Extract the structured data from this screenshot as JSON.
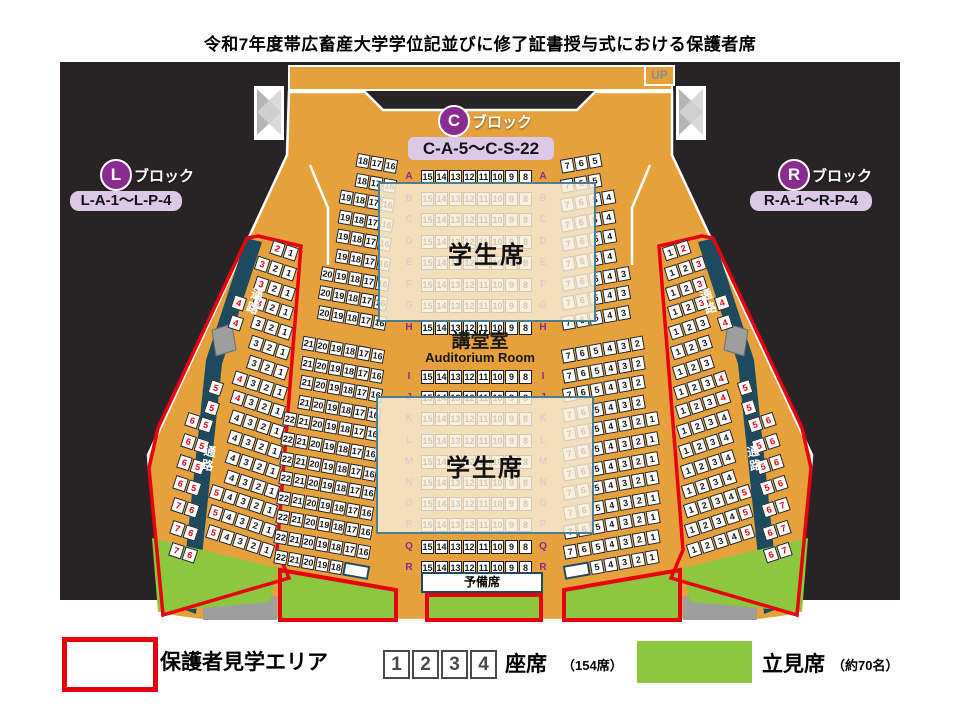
{
  "title": "令和7年度帯広畜産大学学位記並びに修了証書授与式における保護者席",
  "map": {
    "up_label": "UP",
    "blocks": {
      "c": {
        "letter": "C",
        "suffix": "ブロック",
        "range": "C-A-5〜C-S-22"
      },
      "l": {
        "letter": "L",
        "suffix": "ブロック",
        "range": "L-A-1〜L-P-4"
      },
      "r": {
        "letter": "R",
        "suffix": "ブロック",
        "range": "R-A-1〜R-P-4"
      }
    },
    "hall_name": "講堂室",
    "hall_name_en": "Auditorium Room",
    "student_area_label": "学生席",
    "reserve_label": "予備席",
    "aisle_label": "通路",
    "center_block": {
      "row_letters": [
        "A",
        "B",
        "C",
        "D",
        "E",
        "F",
        "G",
        "H",
        "I",
        "J",
        "K",
        "L",
        "M",
        "N",
        "O",
        "P",
        "Q",
        "R"
      ],
      "seat_numbers": [
        "15",
        "14",
        "13",
        "12",
        "11",
        "10",
        "9",
        "8"
      ]
    },
    "left_column_rows": [
      [
        "18",
        "17",
        "16"
      ],
      [
        "18",
        "17",
        "16"
      ],
      [
        "19",
        "18",
        "17",
        "16"
      ],
      [
        "19",
        "18",
        "17",
        "16"
      ],
      [
        "19",
        "18",
        "17",
        "16"
      ],
      [
        "19",
        "18",
        "17",
        "16"
      ],
      [
        "20",
        "19",
        "18",
        "17",
        "16"
      ],
      [
        "20",
        "19",
        "18",
        "17",
        "16"
      ],
      [
        "20",
        "19",
        "18",
        "17",
        "16"
      ],
      [
        "21",
        "20",
        "19",
        "18",
        "17",
        "16"
      ],
      [
        "21",
        "20",
        "19",
        "18",
        "17",
        "16"
      ],
      [
        "21",
        "20",
        "19",
        "18",
        "17",
        "16"
      ],
      [
        "21",
        "20",
        "19",
        "18",
        "17",
        "16"
      ],
      [
        "22",
        "21",
        "20",
        "19",
        "18",
        "17",
        "16"
      ],
      [
        "22",
        "21",
        "20",
        "19",
        "18",
        "17",
        "16"
      ],
      [
        "22",
        "21",
        "20",
        "19",
        "18",
        "17",
        "16"
      ],
      [
        "22",
        "21",
        "20",
        "19",
        "18",
        "17",
        "16"
      ],
      [
        "22",
        "21",
        "20",
        "19",
        "18",
        "17",
        "16"
      ],
      [
        "22",
        "21",
        "20",
        "19",
        "18",
        "17",
        "16"
      ],
      [
        "22",
        "21",
        "20",
        "19",
        "18",
        "17",
        "16"
      ],
      [
        "22",
        "21",
        "20",
        "19",
        "18",
        ""
      ]
    ],
    "right_column_rows": [
      [
        "7",
        "6",
        "5"
      ],
      [
        "7",
        "6",
        "5"
      ],
      [
        "7",
        "6",
        "5",
        "4"
      ],
      [
        "7",
        "6",
        "5",
        "4"
      ],
      [
        "7",
        "6",
        "5",
        "4"
      ],
      [
        "7",
        "6",
        "5",
        "4"
      ],
      [
        "7",
        "6",
        "5",
        "4",
        "3"
      ],
      [
        "7",
        "6",
        "5",
        "4",
        "3"
      ],
      [
        "7",
        "6",
        "5",
        "4",
        "3"
      ],
      [
        "7",
        "6",
        "5",
        "4",
        "3",
        "2"
      ],
      [
        "7",
        "6",
        "5",
        "4",
        "3",
        "2"
      ],
      [
        "7",
        "6",
        "5",
        "4",
        "3",
        "2"
      ],
      [
        "7",
        "6",
        "5",
        "4",
        "3",
        "2"
      ],
      [
        "7",
        "6",
        "5",
        "4",
        "3",
        "2",
        "1"
      ],
      [
        "7",
        "6",
        "5",
        "4",
        "3",
        "2",
        "1"
      ],
      [
        "7",
        "6",
        "5",
        "4",
        "3",
        "2",
        "1"
      ],
      [
        "7",
        "6",
        "5",
        "4",
        "3",
        "2",
        "1"
      ],
      [
        "7",
        "6",
        "5",
        "4",
        "3",
        "2",
        "1"
      ],
      [
        "7",
        "6",
        "5",
        "4",
        "3",
        "2",
        "1"
      ],
      [
        "7",
        "6",
        "5",
        "4",
        "3",
        "2",
        "1"
      ],
      [
        "",
        "5",
        "4",
        "3",
        "2",
        "1"
      ]
    ],
    "left_wing": {
      "main_rows": [
        {
          "s": [
            "2",
            "1"
          ],
          "red": [
            0
          ]
        },
        {
          "s": [
            "3",
            "2",
            "1"
          ],
          "red": [
            0
          ]
        },
        {
          "s": [
            "3",
            "2",
            "1"
          ],
          "red": [
            0
          ]
        },
        {
          "s": [
            "3",
            "2",
            "1"
          ],
          "red": [
            0
          ]
        },
        {
          "s": [
            "3",
            "2",
            "1"
          ],
          "red": []
        },
        {
          "s": [
            "3",
            "2",
            "1"
          ],
          "red": []
        },
        {
          "s": [
            "3",
            "2",
            "1"
          ],
          "red": []
        },
        {
          "s": [
            "4",
            "3",
            "2",
            "1"
          ],
          "red": [
            0
          ]
        },
        {
          "s": [
            "4",
            "3",
            "2",
            "1"
          ],
          "red": [
            0
          ]
        },
        {
          "s": [
            "4",
            "3",
            "2",
            "1"
          ],
          "red": []
        },
        {
          "s": [
            "4",
            "3",
            "2",
            "1"
          ],
          "red": []
        },
        {
          "s": [
            "4",
            "3",
            "2",
            "1"
          ],
          "red": []
        },
        {
          "s": [
            "4",
            "3",
            "2",
            "1"
          ],
          "red": []
        },
        {
          "s": [
            "5",
            "4",
            "3",
            "2",
            "1"
          ],
          "red": [
            0
          ]
        },
        {
          "s": [
            "5",
            "4",
            "3",
            "2",
            "1"
          ],
          "red": [
            0
          ]
        },
        {
          "s": [
            "5",
            "4",
            "3",
            "2",
            "1"
          ],
          "red": [
            0
          ]
        }
      ],
      "outer_rows": [
        {
          "s": [
            "4"
          ],
          "red": [
            0
          ]
        },
        {
          "s": [
            "4"
          ],
          "red": [
            0
          ]
        },
        {
          "s": [
            "5"
          ],
          "red": [
            0
          ]
        },
        {
          "s": [
            "5"
          ],
          "red": [
            0
          ]
        },
        {
          "s": [
            "6",
            "5"
          ],
          "red": [
            0,
            1
          ]
        },
        {
          "s": [
            "6",
            "5"
          ],
          "red": [
            0,
            1
          ]
        },
        {
          "s": [
            "6",
            "5"
          ],
          "red": [
            0,
            1
          ]
        },
        {
          "s": [
            "6",
            "5"
          ],
          "red": [
            0,
            1
          ]
        },
        {
          "s": [
            "7",
            "6"
          ],
          "red": [
            0,
            1
          ]
        },
        {
          "s": [
            "7",
            "6"
          ],
          "red": [
            0,
            1
          ]
        },
        {
          "s": [
            "7",
            "6"
          ],
          "red": [
            0,
            1
          ]
        }
      ]
    },
    "right_wing": {
      "main_rows": [
        {
          "s": [
            "1",
            "2"
          ],
          "red": [
            1
          ]
        },
        {
          "s": [
            "1",
            "2",
            "3"
          ],
          "red": [
            2
          ]
        },
        {
          "s": [
            "1",
            "2",
            "3"
          ],
          "red": [
            2
          ]
        },
        {
          "s": [
            "1",
            "2",
            "3"
          ],
          "red": [
            2
          ]
        },
        {
          "s": [
            "1",
            "2",
            "3"
          ],
          "red": []
        },
        {
          "s": [
            "1",
            "2",
            "3"
          ],
          "red": []
        },
        {
          "s": [
            "1",
            "2",
            "3"
          ],
          "red": []
        },
        {
          "s": [
            "1",
            "2",
            "3",
            "4"
          ],
          "red": [
            3
          ]
        },
        {
          "s": [
            "1",
            "2",
            "3",
            "4"
          ],
          "red": [
            3
          ]
        },
        {
          "s": [
            "1",
            "2",
            "3",
            "4"
          ],
          "red": []
        },
        {
          "s": [
            "1",
            "2",
            "3",
            "4"
          ],
          "red": []
        },
        {
          "s": [
            "1",
            "2",
            "3",
            "4"
          ],
          "red": []
        },
        {
          "s": [
            "1",
            "2",
            "3",
            "4"
          ],
          "red": []
        },
        {
          "s": [
            "1",
            "2",
            "3",
            "4",
            "5"
          ],
          "red": [
            4
          ]
        },
        {
          "s": [
            "1",
            "2",
            "3",
            "4",
            "5"
          ],
          "red": [
            4
          ]
        },
        {
          "s": [
            "1",
            "2",
            "3",
            "4",
            "5"
          ],
          "red": [
            4
          ]
        }
      ],
      "outer_rows": [
        {
          "s": [
            "4"
          ],
          "red": [
            0
          ]
        },
        {
          "s": [
            "4"
          ],
          "red": [
            0
          ]
        },
        {
          "s": [
            "5"
          ],
          "red": [
            0
          ]
        },
        {
          "s": [
            "5"
          ],
          "red": [
            0
          ]
        },
        {
          "s": [
            "5",
            "6"
          ],
          "red": [
            0,
            1
          ]
        },
        {
          "s": [
            "5",
            "6"
          ],
          "red": [
            0,
            1
          ]
        },
        {
          "s": [
            "5",
            "6"
          ],
          "red": [
            0,
            1
          ]
        },
        {
          "s": [
            "5",
            "6"
          ],
          "red": [
            0,
            1
          ]
        },
        {
          "s": [
            "6",
            "7"
          ],
          "red": [
            0,
            1
          ]
        },
        {
          "s": [
            "6",
            "7"
          ],
          "red": [
            0,
            1
          ]
        },
        {
          "s": [
            "6",
            "7"
          ],
          "red": [
            0,
            1
          ]
        }
      ]
    }
  },
  "legend": {
    "guardian_area_label": "保護者見学エリア",
    "seat_sample": [
      "1",
      "2",
      "3",
      "4"
    ],
    "seat_label": "座席",
    "seat_count": "（154席）",
    "standing_label": "立見席",
    "standing_count": "（約70名）",
    "colors": {
      "guardian_outline": "#e8000f",
      "standing_green": "#8dc63f",
      "hall_orange": "#e6a13c",
      "aisle_teal": "#1c4a5f"
    }
  }
}
